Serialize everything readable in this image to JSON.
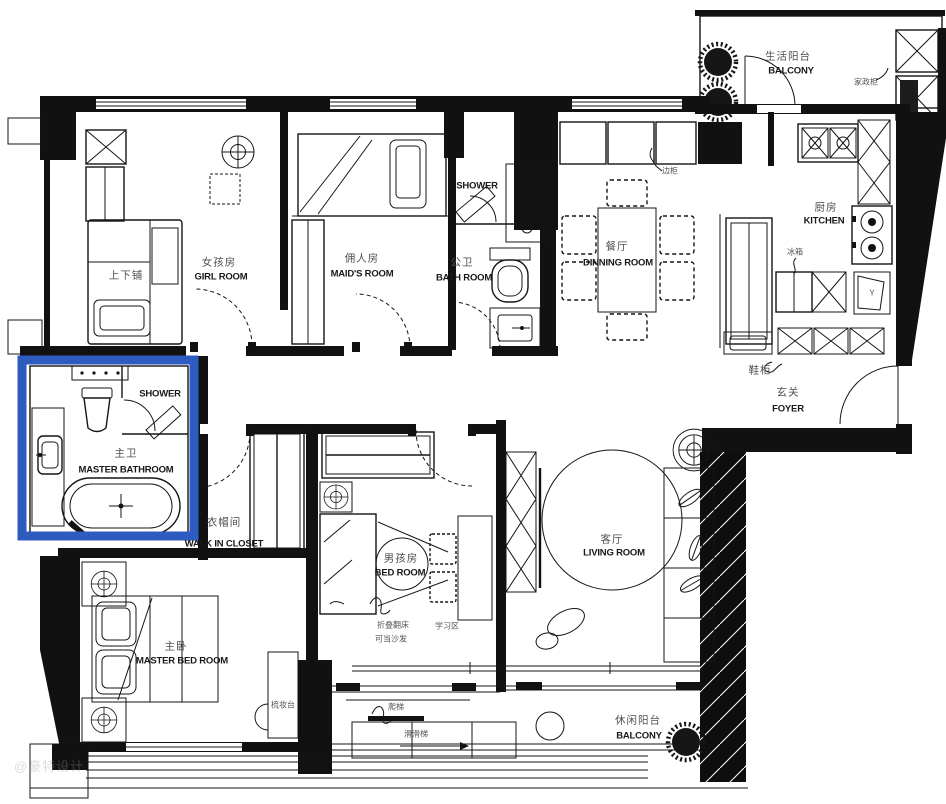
{
  "title": "apartment-floor-plan",
  "highlight_color": "#2e5bbf",
  "watermark": "@豪特设计",
  "rooms": {
    "life_balcony": {
      "zh": "生活阳台",
      "en": "BALCONY"
    },
    "girl_room": {
      "zh": "女孩房",
      "en": "GIRL ROOM"
    },
    "maid_room": {
      "zh": "佣人房",
      "en": "MAID'S ROOM"
    },
    "public_shower": {
      "en": "SHOWER"
    },
    "public_bath": {
      "zh": "公卫",
      "en": "BATH ROOM"
    },
    "dining_room": {
      "zh": "餐厅",
      "en": "DINNING ROOM"
    },
    "kitchen": {
      "zh": "厨房",
      "en": "KITCHEN"
    },
    "foyer": {
      "zh": "玄关",
      "en": "FOYER"
    },
    "master_shower": {
      "en": "SHOWER"
    },
    "master_bathroom": {
      "zh": "主卫",
      "en": "MASTER BATHROOM"
    },
    "walk_in_closet": {
      "zh": "衣帽间",
      "en": "WALK IN CLOSET"
    },
    "boy_room": {
      "zh": "男孩房",
      "en": "BED ROOM"
    },
    "living_room": {
      "zh": "客厅",
      "en": "LIVING ROOM"
    },
    "master_bedroom": {
      "zh": "主卧",
      "en": "MASTER BED ROOM"
    },
    "leisure_balcony": {
      "zh": "休闲阳台",
      "en": "BALCONY"
    }
  },
  "furniture_labels": {
    "bunk_bed": "上下铺",
    "housekeeping_cabinet": "家政柜",
    "side_cabinet": "边柜",
    "fridge": "冰箱",
    "washer": "Y",
    "shoe_cabinet": "鞋柜",
    "dresser": "梳妆台",
    "ladder": "爬梯",
    "slide": "滑滑梯",
    "folding_bed_line1": "折叠翻床",
    "folding_bed_line2": "可当沙发",
    "study_area": "学习区"
  }
}
